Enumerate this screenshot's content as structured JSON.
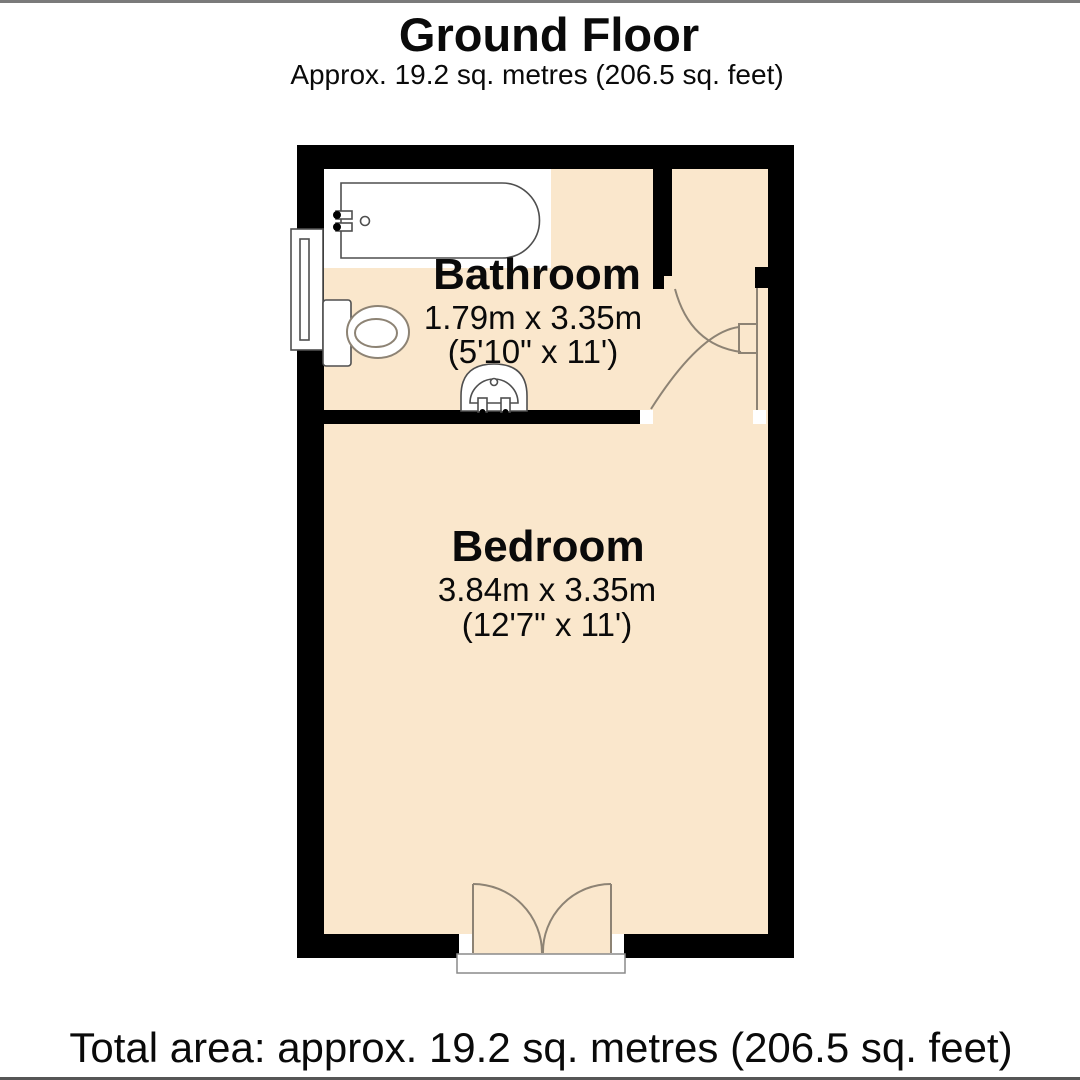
{
  "header": {
    "title": "Ground Floor",
    "subtitle": "Approx. 19.2 sq. metres (206.5 sq. feet)"
  },
  "rooms": {
    "bathroom": {
      "name": "Bathroom",
      "size_metric": "1.79m x 3.35m",
      "size_imperial": "(5'10\" x 11')"
    },
    "bedroom": {
      "name": "Bedroom",
      "size_metric": "3.84m x 3.35m",
      "size_imperial": "(12'7\" x 11')"
    }
  },
  "footer": {
    "total_area": "Total area: approx. 19.2 sq. metres (206.5 sq. feet)"
  },
  "fixtures": {
    "icons": [
      "bathtub-icon",
      "toilet-icon",
      "sink-icon",
      "window-icon",
      "door-swing-icon",
      "double-entrance-door-icon"
    ]
  },
  "colors": {
    "floor_fill": "#fae7cc",
    "wall": "#000000",
    "door_swing": "#8d8374",
    "fixture_stroke": "#4f4f4f",
    "rule": "#7a7a7a"
  }
}
